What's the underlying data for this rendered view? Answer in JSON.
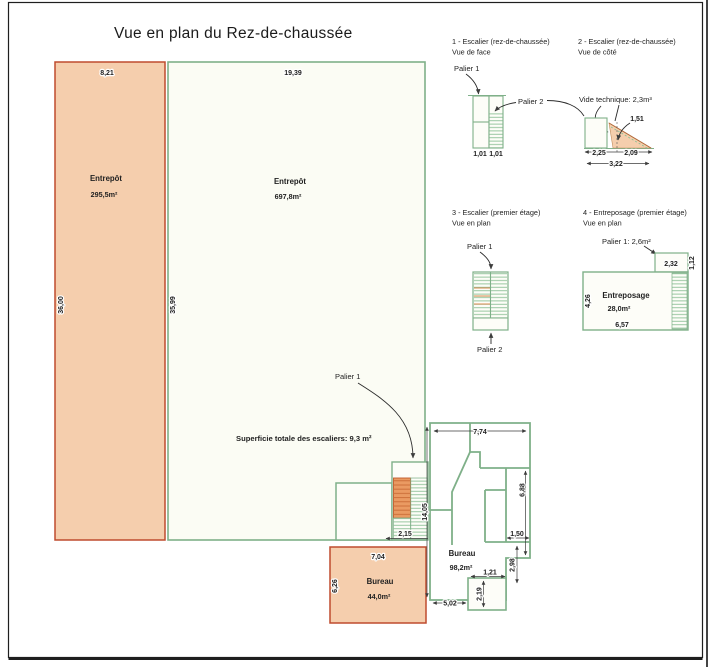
{
  "title": "Vue en plan du Rez-de-chaussée",
  "colors": {
    "wall_green": "#7fb089",
    "salmon_fill": "#f5cead",
    "salmon_border": "#bf4b2e",
    "mint_fill": "#fbfcf4",
    "stair_orange": "#ea9a62",
    "ink": "#1d1d1d"
  },
  "plan": {
    "entrepot_left": {
      "label": "Entrepôt",
      "area": "295,5m²",
      "dim_top": "8,21",
      "dim_side": "36,00"
    },
    "entrepot_main": {
      "label": "Entrepôt",
      "area": "697,8m²",
      "dim_top": "19,39",
      "dim_side": "35,99"
    },
    "stairs_note": "Superficie totale des escaliers: 9,3 m²",
    "palier1_label": "Palier 1",
    "stair_width": "2,15",
    "bureau_small": {
      "label": "Bureau",
      "area": "44,0m²",
      "dim_top": "7,04",
      "dim_side": "6,26"
    },
    "office": {
      "label": "Bureau",
      "area": "98,2m²",
      "dim_top": "7,74",
      "dim_left": "14,05",
      "dim_right": "6,88",
      "dim_room_w": "1,50",
      "dim_room_h": "2,98",
      "dim_notch_w": "1,21",
      "dim_notch_h": "2,19",
      "dim_bottom": "5,02"
    }
  },
  "detail1": {
    "title": "1 - Escalier (rez-de-chaussée)",
    "subtitle": "Vue de face",
    "palier1": "Palier 1",
    "palier2": "Palier 2",
    "dim_left": "1,01",
    "dim_right": "1,01"
  },
  "detail2": {
    "title": "2 - Escalier (rez-de-chaussée)",
    "subtitle": "Vue de côté",
    "note": "Vide technique: 2,3m³",
    "dim_height": "1,51",
    "dim_a": "2,25",
    "dim_b": "2,09",
    "dim_total": "3,22"
  },
  "detail3": {
    "title": "3 - Escalier (premier étage)",
    "subtitle": "Vue en plan",
    "palier1": "Palier 1",
    "palier2": "Palier 2"
  },
  "detail4": {
    "title": "4 - Entreposage (premier étage)",
    "subtitle": "Vue en plan",
    "note": "Palier 1: 2,6m²",
    "label": "Entreposage",
    "area": "28,0m²",
    "dim_palier_w": "2,32",
    "dim_palier_h": "1,12",
    "dim_left": "4,26",
    "dim_bottom": "6,57"
  }
}
